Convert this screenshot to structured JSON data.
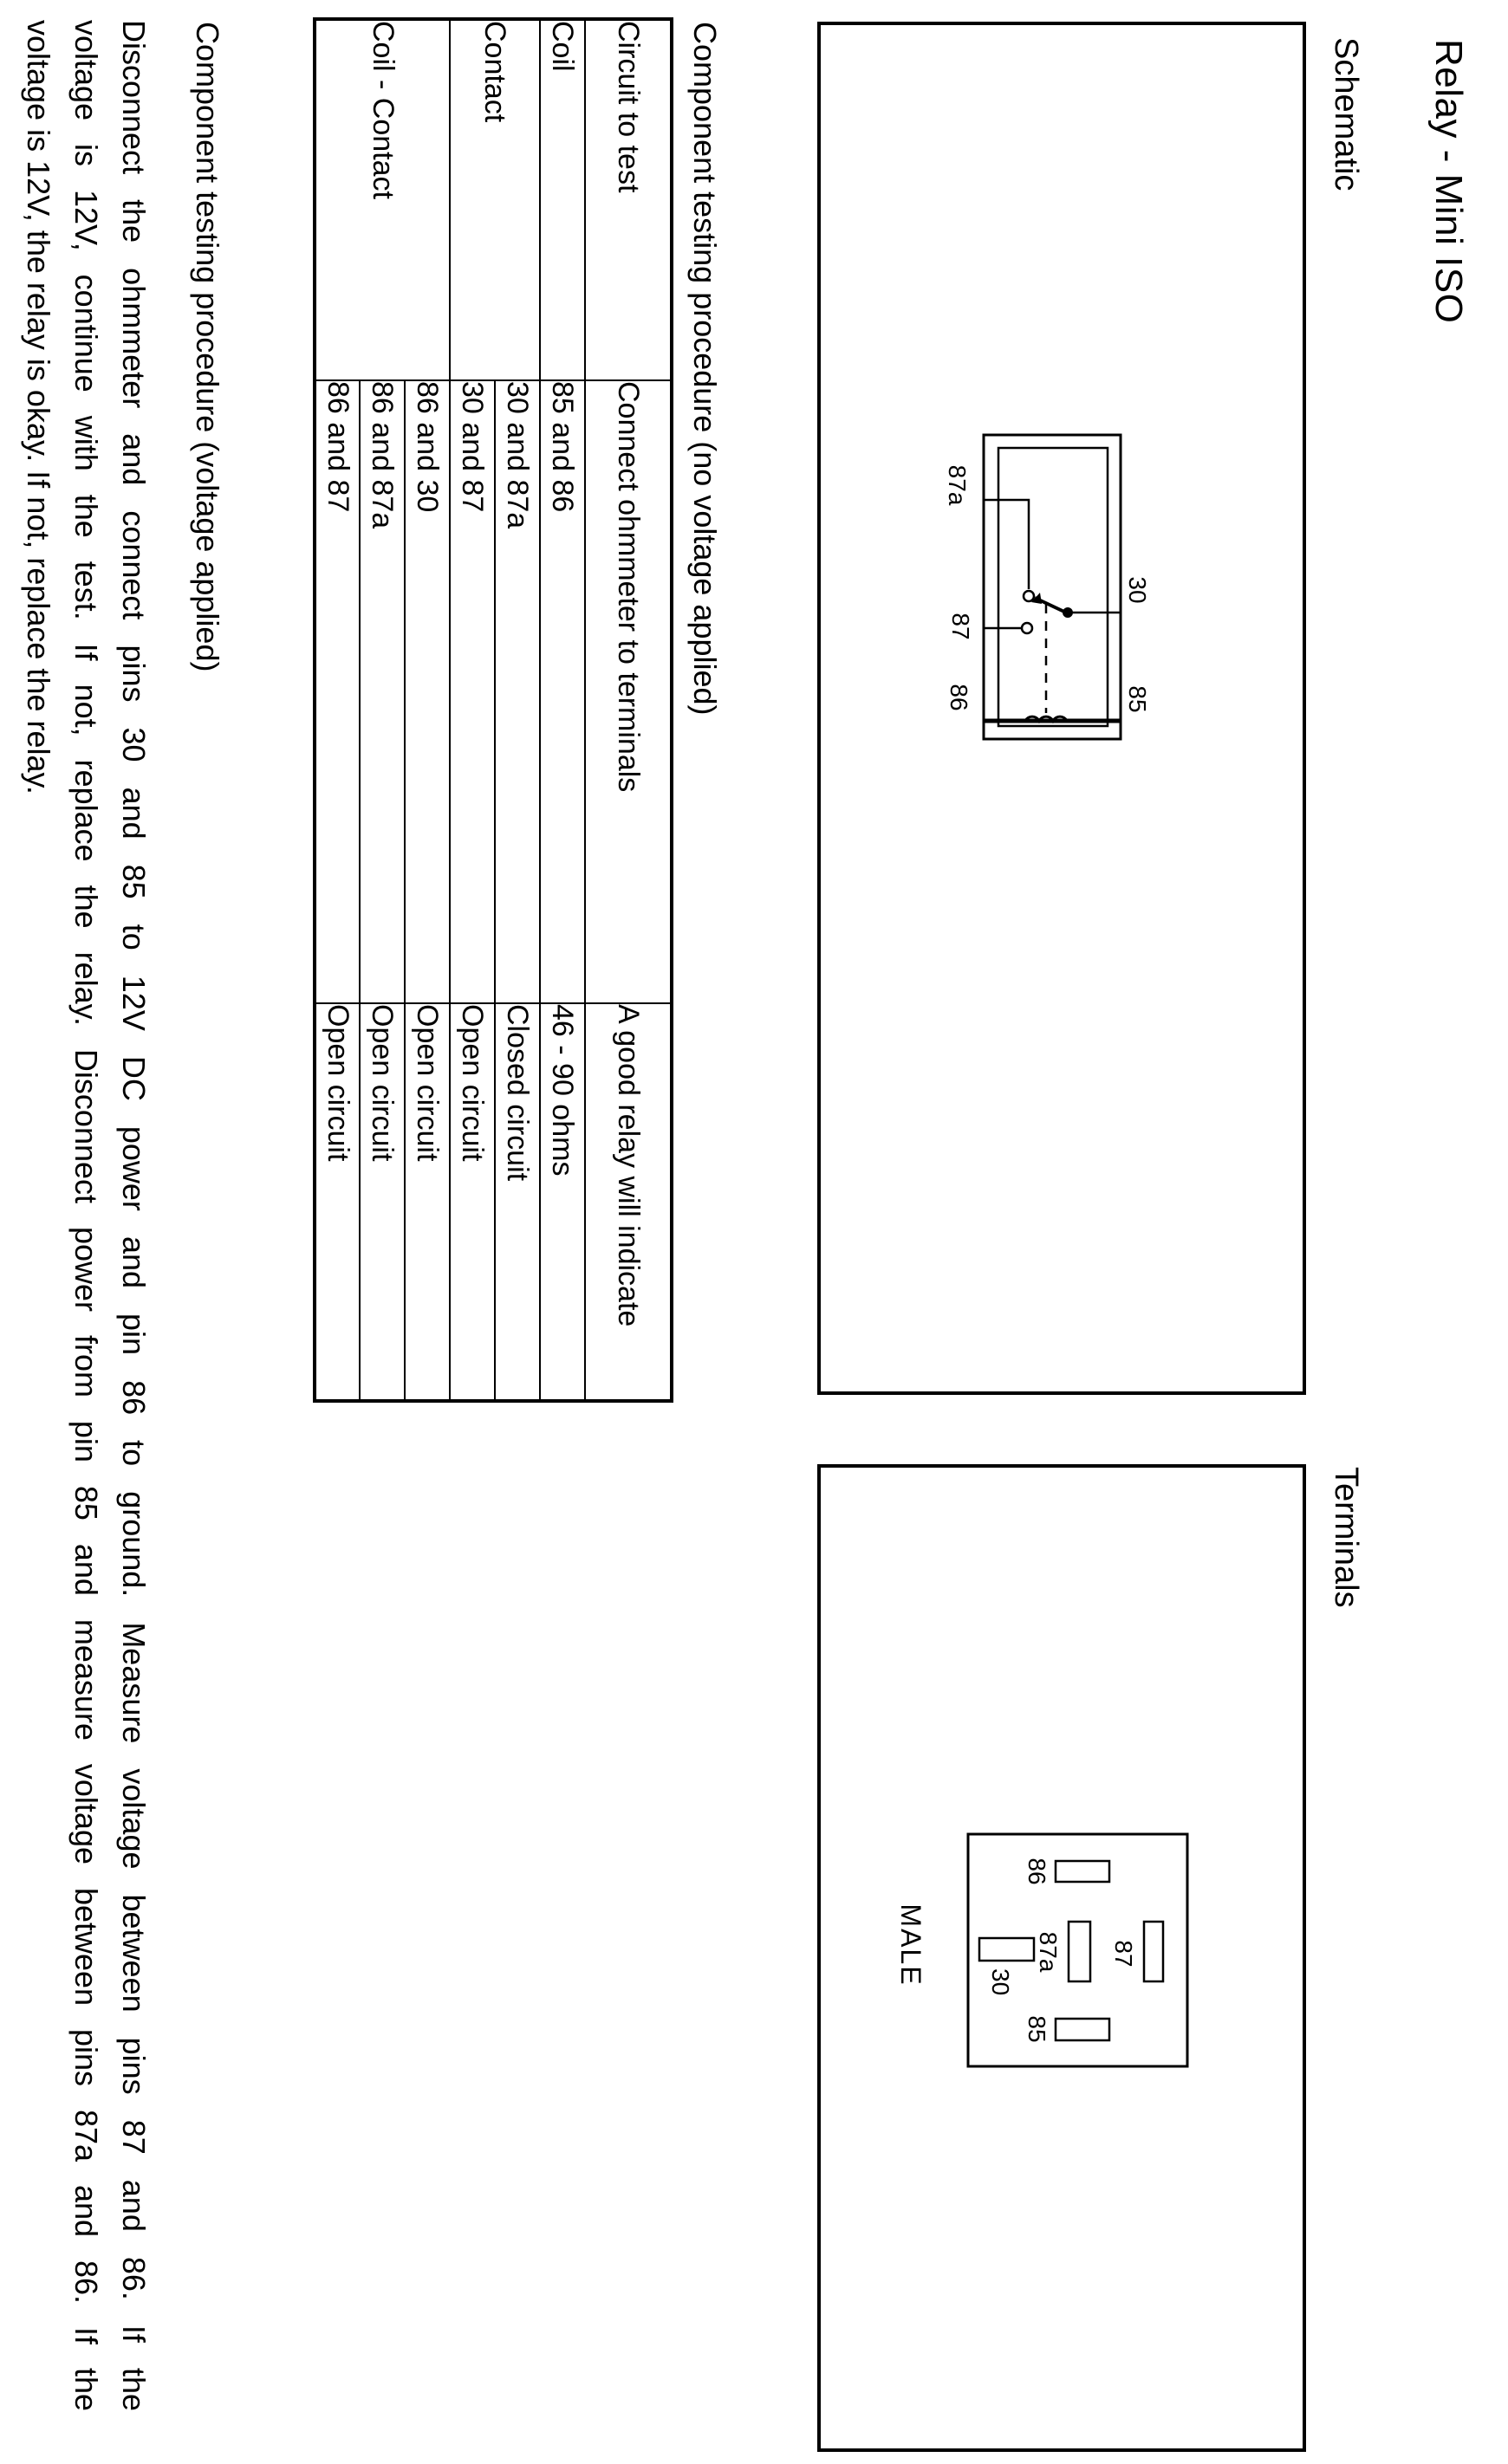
{
  "page": {
    "title": "Relay - Mini ISO"
  },
  "colors": {
    "paper": "#ffffff",
    "ink": "#000000"
  },
  "pins": {
    "87a": "87a",
    "87": "87",
    "86": "86",
    "30": "30",
    "85": "85"
  },
  "schematic": {
    "heading": "Schematic"
  },
  "terminals": {
    "heading": "Terminals",
    "connector_label": "MALE"
  },
  "no_voltage_test": {
    "heading": "Component testing procedure (no voltage applied)",
    "table": {
      "columns": [
        "Circuit to test",
        "Connect ohmmeter to terminals",
        "A good relay will indicate"
      ],
      "rows": [
        {
          "circuit": "Coil",
          "terminals": "85 and 86",
          "indication": "46 - 90 ohms"
        },
        {
          "circuit": "Contact",
          "terminals": "30 and 87a",
          "indication": "Closed circuit"
        },
        {
          "circuit": "",
          "terminals": "30 and 87",
          "indication": "Open circuit"
        },
        {
          "circuit": "Coil - Contact",
          "terminals": "86 and 30",
          "indication": "Open circuit"
        },
        {
          "circuit": "",
          "terminals": "86 and 87a",
          "indication": "Open circuit"
        },
        {
          "circuit": "",
          "terminals": "86 and 87",
          "indication": "Open circuit"
        }
      ]
    }
  },
  "voltage_test": {
    "heading": "Component testing procedure (voltage applied)",
    "lines": [
      "Disconnect the ohmmeter and connect pins 30 and 85 to 12V DC power and pin 86 to ground. Measure voltage between pins 87 and 86. If the",
      "voltage is 12V, continue with the test. If not, replace the relay. Disconnect power from pin 85 and measure voltage between pins 87a and 86. If the",
      "voltage is 12V, the relay is okay. If not, replace the relay."
    ]
  }
}
